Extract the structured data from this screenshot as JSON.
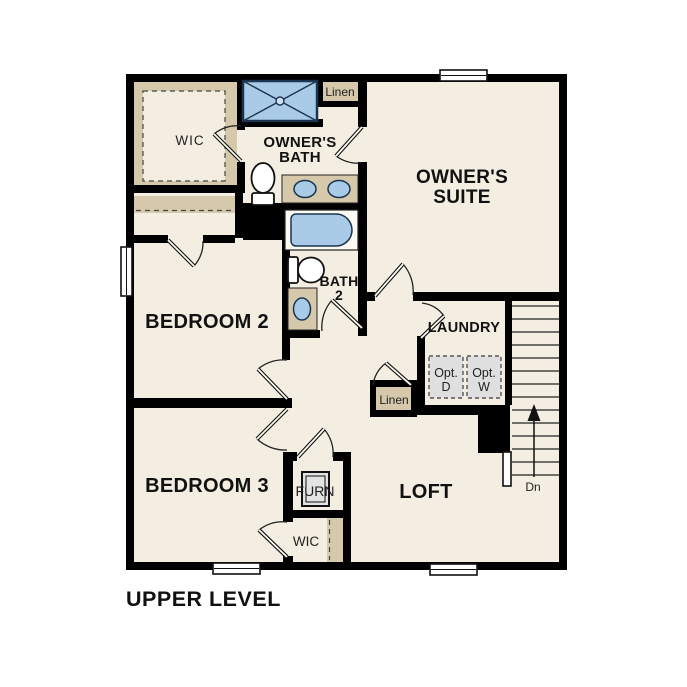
{
  "title": "UPPER LEVEL",
  "labels": {
    "wic_upper": "WIC",
    "owners_bath_1": "OWNER'S",
    "owners_bath_2": "BATH",
    "linen_upper": "Linen",
    "owners_suite_1": "OWNER'S",
    "owners_suite_2": "SUITE",
    "bedroom2": "BEDROOM 2",
    "bath2_1": "BATH",
    "bath2_2": "2",
    "laundry": "LAUNDRY",
    "opt_d_1": "Opt.",
    "opt_d_2": "D",
    "opt_w_1": "Opt.",
    "opt_w_2": "W",
    "linen_lower": "Linen",
    "bedroom3": "BEDROOM 3",
    "furn": "FURN",
    "wic_lower": "WIC",
    "loft": "LOFT",
    "stairs_direction": "Dn"
  },
  "colors": {
    "wall": "#000000",
    "outside": "#ffffff",
    "floor": "#f3eee1",
    "tan": "#d5c8ab",
    "blue": "#a9cbe8",
    "blue_stroke": "#1b3550",
    "gray": "#dfdfdf"
  }
}
